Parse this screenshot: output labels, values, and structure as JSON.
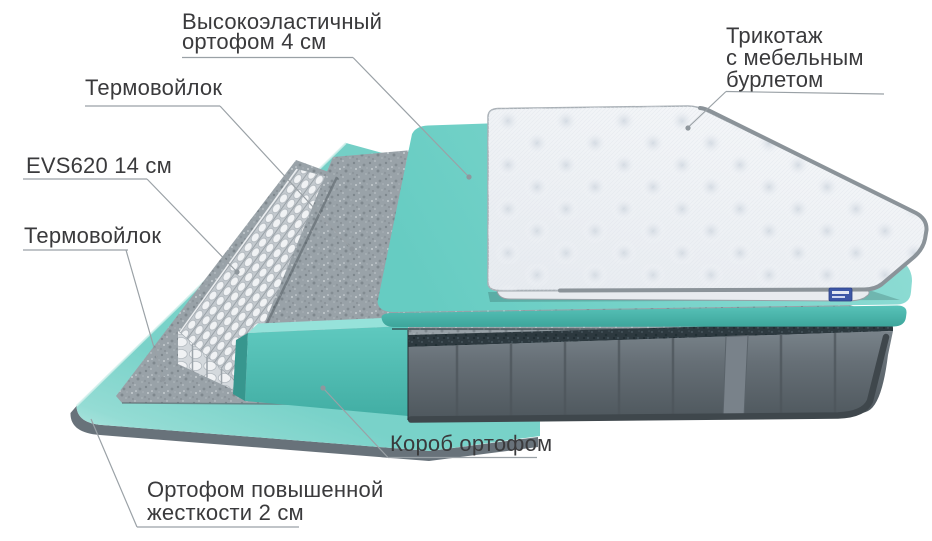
{
  "diagram": {
    "type": "mattress-layers-exploded-view",
    "labels": {
      "top_foam": {
        "line1": "Высокоэластичный",
        "line2": "ортофом 4 см"
      },
      "cover": {
        "line1": "Трикотаж",
        "line2": "с мебельным",
        "line3": "бурлетом"
      },
      "felt_upper": {
        "text": "Термовойлок"
      },
      "springs": {
        "text": "EVS620 14 см"
      },
      "felt_lower": {
        "text": "Термовойлок"
      },
      "box_foam": {
        "text": "Короб ортофом"
      },
      "base_foam": {
        "line1": "Ортофом повышенной",
        "line2": "жесткости 2 см"
      }
    },
    "icons": {
      "brand_tag": "brand-tag"
    },
    "colors": {
      "label-text": "#3a3a3c",
      "leader-line": "#9aa1a6",
      "teal-base": "#74cfc6",
      "teal-base-light": "#c2ebe6",
      "teal-slab": "#7dd5cc",
      "teal-slab-front": "#4db8ae",
      "teal-korob": "#5fc9bf",
      "teal-korob-side": "#37968e",
      "teal-korob-top": "#96e2da",
      "felt-gray": "#99a2a8",
      "spring-white": "#f0f2f4",
      "spring-gap": "#c3c9ce",
      "body-velvet": "#666f76",
      "body-rim": "#2d393f",
      "body-piping": "#3f474c",
      "body-handle": "#79828a",
      "cover-white": "#f5f7f9",
      "cover-binding": "#8b9399",
      "base-rim-gray": "#68727a",
      "tag-blue": "#3d56a6"
    }
  }
}
